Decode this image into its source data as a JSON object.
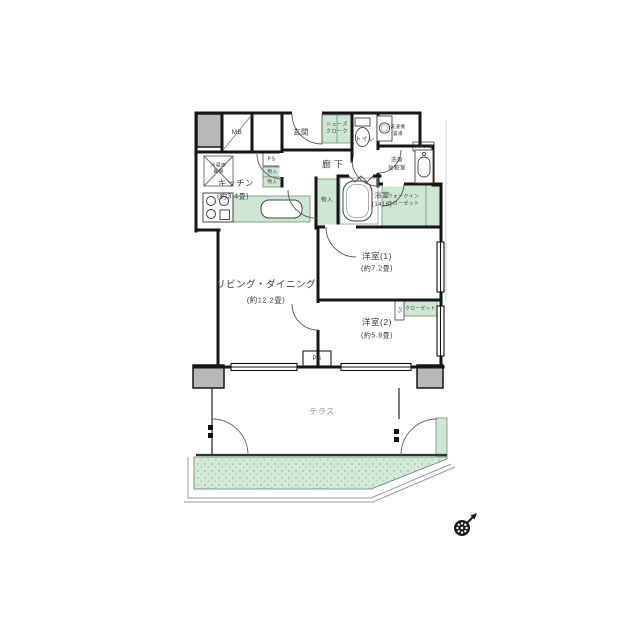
{
  "rooms": {
    "living": {
      "name": "リビング・ダイニング",
      "size": "(約12.2畳)"
    },
    "bedroom1": {
      "name": "洋室(1)",
      "size": "(約7.2畳)"
    },
    "bedroom2": {
      "name": "洋室(2)",
      "size": "(約5.8畳)"
    },
    "kitchen": {
      "name": "キッチン",
      "size": "(約3.4畳)"
    },
    "bath": {
      "name": "浴室",
      "size": "(1416)"
    },
    "hallway": "廊下",
    "entrance": "玄関",
    "toilet": "トイレ",
    "terrace": "テラス",
    "mb": "MB"
  },
  "storage": {
    "shoes_closet": [
      "シューズ",
      "クローク"
    ],
    "wic": [
      "ウォークイン",
      "クローゼット"
    ],
    "closet": "クローゼット",
    "hall_storage": "物入",
    "kitchen_storage_1": "物入",
    "kitchen_storage_2": "物入",
    "linen": "リネン庫",
    "laundry": [
      "洗濯機",
      "置場"
    ],
    "fridge": [
      "冷蔵庫",
      "置場"
    ],
    "powder": [
      "洗面",
      "化粧室"
    ]
  },
  "utility": {
    "ps_kitchen": "PS",
    "ps_bedroom": "PS",
    "ps_bottom": "PS"
  },
  "icons": {
    "compass": "compass-north-arrow"
  },
  "colors": {
    "closet_green": "#cde7d2",
    "terrace_green": "#d2ead7",
    "wall": "#161616",
    "pillar_gray": "#b8b8b8"
  }
}
